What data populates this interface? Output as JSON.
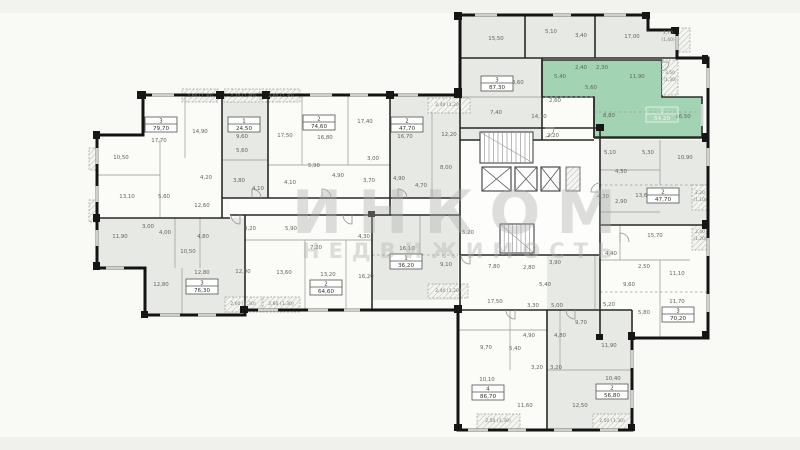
{
  "watermark": {
    "line1": "ИНКОМ",
    "line2": "НЕДВИЖИМОСТЬ"
  },
  "colors": {
    "highlight": "#a2d3b3",
    "room_gray": "#e7eae4",
    "room_white": "#fbfbf8",
    "wall": "#141414",
    "room_text": "#5f645c",
    "balcony_text": "#787c72",
    "watermark": "#abaeab"
  },
  "units": [
    {
      "rooms": "3",
      "area": "79,70",
      "x": 161,
      "y": 124,
      "style": "normal"
    },
    {
      "rooms": "1",
      "area": "24,50",
      "x": 244,
      "y": 124,
      "style": "normal"
    },
    {
      "rooms": "2",
      "area": "74,60",
      "x": 319,
      "y": 122,
      "style": "normal"
    },
    {
      "rooms": "2",
      "area": "47,70",
      "x": 407,
      "y": 124,
      "style": "normal"
    },
    {
      "rooms": "3",
      "area": "87,30",
      "x": 497,
      "y": 83,
      "style": "normal"
    },
    {
      "rooms": "2",
      "area": "54,20",
      "x": 662,
      "y": 114,
      "style": "green"
    },
    {
      "rooms": "2",
      "area": "47,70",
      "x": 663,
      "y": 195,
      "style": "normal"
    },
    {
      "rooms": "3",
      "area": "70,20",
      "x": 678,
      "y": 314,
      "style": "normal"
    },
    {
      "rooms": "2",
      "area": "56,80",
      "x": 612,
      "y": 391,
      "style": "normal"
    },
    {
      "rooms": "4",
      "area": "86,70",
      "x": 488,
      "y": 392,
      "style": "normal"
    },
    {
      "rooms": "1",
      "area": "36,20",
      "x": 406,
      "y": 261,
      "style": "normal"
    },
    {
      "rooms": "2",
      "area": "64,60",
      "x": 326,
      "y": 287,
      "style": "normal"
    },
    {
      "rooms": "3",
      "area": "76,30",
      "x": 202,
      "y": 286,
      "style": "normal"
    }
  ],
  "room_labels": [
    {
      "t": "17,70",
      "x": 159,
      "y": 142
    },
    {
      "t": "14,90",
      "x": 200,
      "y": 133
    },
    {
      "t": "10,50",
      "x": 121,
      "y": 159
    },
    {
      "t": "13,10",
      "x": 127,
      "y": 198
    },
    {
      "t": "4,20",
      "x": 206,
      "y": 179
    },
    {
      "t": "5,60",
      "x": 164,
      "y": 198
    },
    {
      "t": "12,60",
      "x": 202,
      "y": 207
    },
    {
      "t": "9,60",
      "x": 242,
      "y": 138
    },
    {
      "t": "5,60",
      "x": 242,
      "y": 152
    },
    {
      "t": "3,80",
      "x": 239,
      "y": 182
    },
    {
      "t": "4,10",
      "x": 258,
      "y": 190
    },
    {
      "t": "17,50",
      "x": 285,
      "y": 137
    },
    {
      "t": "16,80",
      "x": 325,
      "y": 139
    },
    {
      "t": "17,40",
      "x": 365,
      "y": 123
    },
    {
      "t": "5,90",
      "x": 314,
      "y": 167
    },
    {
      "t": "4,10",
      "x": 290,
      "y": 184
    },
    {
      "t": "4,90",
      "x": 338,
      "y": 177
    },
    {
      "t": "3,00",
      "x": 373,
      "y": 160
    },
    {
      "t": "3,70",
      "x": 369,
      "y": 182
    },
    {
      "t": "4,90",
      "x": 399,
      "y": 180
    },
    {
      "t": "4,70",
      "x": 421,
      "y": 187
    },
    {
      "t": "16,70",
      "x": 405,
      "y": 138
    },
    {
      "t": "12,20",
      "x": 449,
      "y": 136
    },
    {
      "t": "8,00",
      "x": 446,
      "y": 169
    },
    {
      "t": "15,50",
      "x": 496,
      "y": 40
    },
    {
      "t": "5,10",
      "x": 551,
      "y": 33
    },
    {
      "t": "3,40",
      "x": 581,
      "y": 37
    },
    {
      "t": "17,00",
      "x": 632,
      "y": 38
    },
    {
      "t": "18,60",
      "x": 516,
      "y": 84
    },
    {
      "t": "7,40",
      "x": 496,
      "y": 114
    },
    {
      "t": "14,10",
      "x": 539,
      "y": 118
    },
    {
      "t": "2,60",
      "x": 555,
      "y": 102
    },
    {
      "t": "2,20",
      "x": 553,
      "y": 137
    },
    {
      "t": "5,40",
      "x": 560,
      "y": 78
    },
    {
      "t": "2,40",
      "x": 581,
      "y": 69
    },
    {
      "t": "2,30",
      "x": 602,
      "y": 69
    },
    {
      "t": "11,90",
      "x": 637,
      "y": 78
    },
    {
      "t": "5,60",
      "x": 591,
      "y": 89
    },
    {
      "t": "8,80",
      "x": 609,
      "y": 117
    },
    {
      "t": "16,50",
      "x": 683,
      "y": 118
    },
    {
      "t": "5,10",
      "x": 610,
      "y": 154
    },
    {
      "t": "5,30",
      "x": 648,
      "y": 154
    },
    {
      "t": "10,90",
      "x": 685,
      "y": 159
    },
    {
      "t": "4,50",
      "x": 621,
      "y": 173
    },
    {
      "t": "4,30",
      "x": 603,
      "y": 198
    },
    {
      "t": "2,90",
      "x": 621,
      "y": 203
    },
    {
      "t": "13,60",
      "x": 643,
      "y": 197
    },
    {
      "t": "15,70",
      "x": 655,
      "y": 237
    },
    {
      "t": "4,40",
      "x": 611,
      "y": 255
    },
    {
      "t": "2,50",
      "x": 644,
      "y": 268
    },
    {
      "t": "11,10",
      "x": 677,
      "y": 275
    },
    {
      "t": "9,60",
      "x": 629,
      "y": 286
    },
    {
      "t": "5,20",
      "x": 609,
      "y": 306
    },
    {
      "t": "5,80",
      "x": 644,
      "y": 314
    },
    {
      "t": "11,70",
      "x": 677,
      "y": 303
    },
    {
      "t": "11,90",
      "x": 120,
      "y": 238
    },
    {
      "t": "3,00",
      "x": 148,
      "y": 228
    },
    {
      "t": "4,00",
      "x": 165,
      "y": 234
    },
    {
      "t": "4,80",
      "x": 203,
      "y": 238
    },
    {
      "t": "3,20",
      "x": 250,
      "y": 230
    },
    {
      "t": "10,50",
      "x": 188,
      "y": 253
    },
    {
      "t": "12,80",
      "x": 161,
      "y": 286
    },
    {
      "t": "12,80",
      "x": 202,
      "y": 274
    },
    {
      "t": "12,00",
      "x": 243,
      "y": 273
    },
    {
      "t": "5,90",
      "x": 291,
      "y": 230
    },
    {
      "t": "7,20",
      "x": 316,
      "y": 249
    },
    {
      "t": "4,30",
      "x": 364,
      "y": 238
    },
    {
      "t": "13,60",
      "x": 284,
      "y": 274
    },
    {
      "t": "13,20",
      "x": 328,
      "y": 276
    },
    {
      "t": "16,20",
      "x": 366,
      "y": 278
    },
    {
      "t": "16,10",
      "x": 407,
      "y": 250
    },
    {
      "t": "9,10",
      "x": 446,
      "y": 266
    },
    {
      "t": "5,20",
      "x": 468,
      "y": 234
    },
    {
      "t": "7,80",
      "x": 494,
      "y": 268
    },
    {
      "t": "2,80",
      "x": 529,
      "y": 269
    },
    {
      "t": "3,90",
      "x": 555,
      "y": 264
    },
    {
      "t": "5,40",
      "x": 545,
      "y": 286
    },
    {
      "t": "17,50",
      "x": 495,
      "y": 303
    },
    {
      "t": "3,30",
      "x": 533,
      "y": 307
    },
    {
      "t": "5,00",
      "x": 557,
      "y": 307
    },
    {
      "t": "9,70",
      "x": 581,
      "y": 324
    },
    {
      "t": "9,70",
      "x": 486,
      "y": 349
    },
    {
      "t": "5,40",
      "x": 515,
      "y": 350
    },
    {
      "t": "4,90",
      "x": 529,
      "y": 337
    },
    {
      "t": "4,80",
      "x": 560,
      "y": 337
    },
    {
      "t": "3,20",
      "x": 537,
      "y": 369
    },
    {
      "t": "3,20",
      "x": 556,
      "y": 369
    },
    {
      "t": "10,10",
      "x": 487,
      "y": 381
    },
    {
      "t": "11,60",
      "x": 525,
      "y": 407
    },
    {
      "t": "12,50",
      "x": 580,
      "y": 407
    },
    {
      "t": "10,40",
      "x": 613,
      "y": 380
    },
    {
      "t": "11,90",
      "x": 609,
      "y": 347
    }
  ],
  "balcony_labels": [
    {
      "t": "2,60 (1,30)",
      "x": 200,
      "y": 97
    },
    {
      "t": "2,70 (1,40)",
      "x": 243,
      "y": 97
    },
    {
      "t": "2,60 (1,30)",
      "x": 281,
      "y": 97
    },
    {
      "t": "2,40 (1,20)",
      "x": 448,
      "y": 106
    },
    {
      "t": "2,40 (1,20)",
      "x": 448,
      "y": 292
    },
    {
      "t": "2,60 (1,30)",
      "x": 243,
      "y": 305
    },
    {
      "t": "2,60 (1,30)",
      "x": 281,
      "y": 305
    },
    {
      "t": "2,50 (1,30)",
      "x": 498,
      "y": 422
    },
    {
      "t": "2,50 (1,30)",
      "x": 612,
      "y": 422
    }
  ],
  "balcony_labels_2line": [
    {
      "t1": "2,70",
      "t2": "(1,40)",
      "x": 668,
      "y": 34
    },
    {
      "t1": "3,50",
      "t2": "(1,30)",
      "x": 670,
      "y": 74
    },
    {
      "t1": "2,20",
      "t2": "(1,10)",
      "x": 700,
      "y": 194
    },
    {
      "t1": "2,40",
      "t2": "(1,20)",
      "x": 700,
      "y": 233
    }
  ]
}
